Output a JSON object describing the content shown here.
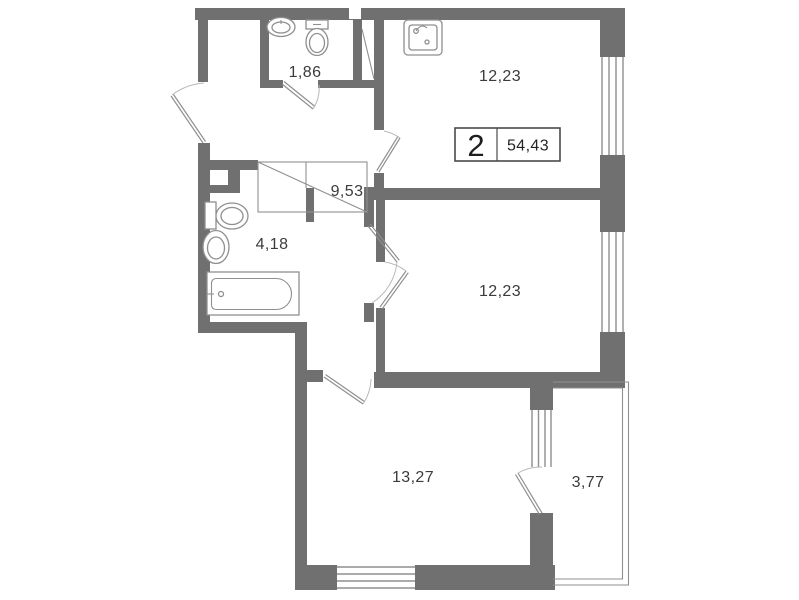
{
  "plan": {
    "title": "apartment-floor-plan",
    "info": {
      "rooms_count": "2",
      "total_area": "54,43"
    },
    "rooms": [
      {
        "name": "wc",
        "area": "1,86"
      },
      {
        "name": "kitchen",
        "area": "12,23"
      },
      {
        "name": "hallway",
        "area": "9,53"
      },
      {
        "name": "bathroom",
        "area": "4,18"
      },
      {
        "name": "bedroom",
        "area": "12,23"
      },
      {
        "name": "living-room",
        "area": "13,27"
      },
      {
        "name": "balcony",
        "area": "3,77"
      }
    ],
    "fixtures": [
      "wc-sink-icon",
      "wc-toilet-icon",
      "kitchen-sink-icon",
      "bathroom-toilet-icon",
      "bathroom-sink-icon",
      "bathtub-icon",
      "wardrobe-icon",
      "vent-shaft-icon"
    ],
    "colors": {
      "wall": "#707070",
      "line": "#8f8f8f",
      "text": "#3b3b3b",
      "bg": "#ffffff"
    }
  }
}
